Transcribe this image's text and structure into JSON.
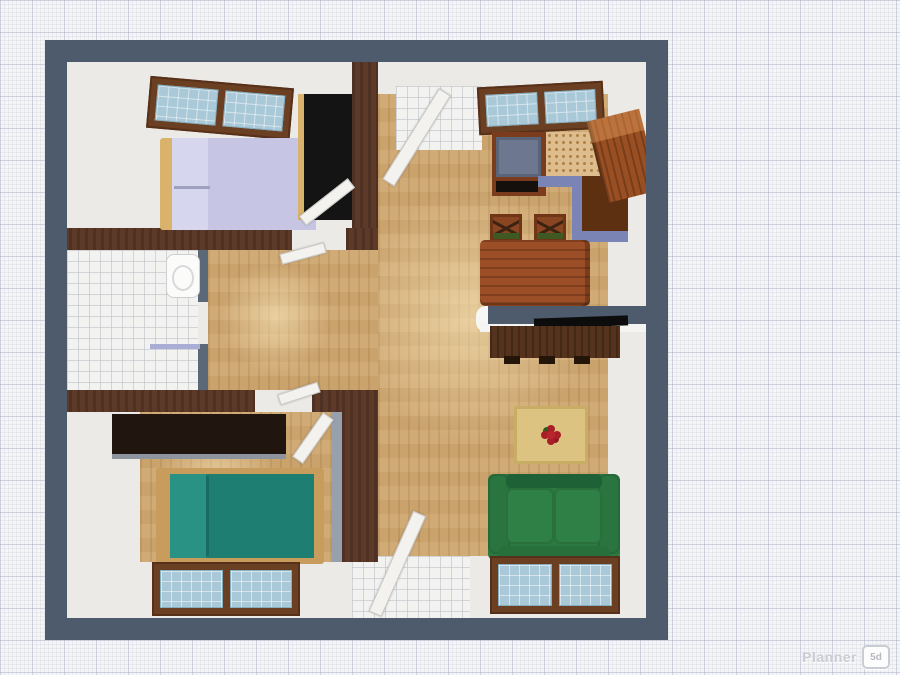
{
  "app": {
    "name": "Planner 5D",
    "watermark": {
      "text": "Planner",
      "badge": "5d"
    }
  },
  "view": {
    "type": "top-down 3D floor plan render",
    "background": "graph-paper grid"
  },
  "palette": {
    "grid_paper": "#f5f5f7",
    "wall_outer": "#4d5b6c",
    "wall_inner_wood": "#5d3a28",
    "floor_wood": "#cfa76f",
    "floor_white": "#eceae7",
    "window_frame": "#6b3f22",
    "window_glass": "#aac9d8",
    "counter_trim_blue": "#7b85b5",
    "counter_speckle": "#ddbd8d",
    "stove_top": "#6d7890",
    "fridge_brown": "#9a4f22",
    "table_brown": "#9c4e26",
    "sofa_green": "#2c7841",
    "bed_teal": "#1e7e71",
    "bed_lavender": "#c6c6e4",
    "dark_furniture": "#1a120c",
    "rug_tan": "#dcc382",
    "rug_flower_red": "#b8252c"
  },
  "rooms": [
    {
      "name": "bedroom-top-left"
    },
    {
      "name": "bathroom"
    },
    {
      "name": "hallway"
    },
    {
      "name": "bedroom-bottom-left"
    },
    {
      "name": "living-room-kitchen"
    }
  ],
  "furniture": [
    "double-bed",
    "wardrobe",
    "bedroom-window",
    "toilet",
    "towel-rail",
    "wall-shelf",
    "single-bed",
    "stove",
    "kitchen-counter",
    "corner-cabinet",
    "fridge",
    "kitchen-window",
    "dining-table",
    "dining-chair",
    "dining-chair",
    "partition-wall",
    "tv",
    "tv-stand",
    "rug",
    "sofa",
    "bottom-windows",
    "entry-door",
    "interior-doors"
  ]
}
